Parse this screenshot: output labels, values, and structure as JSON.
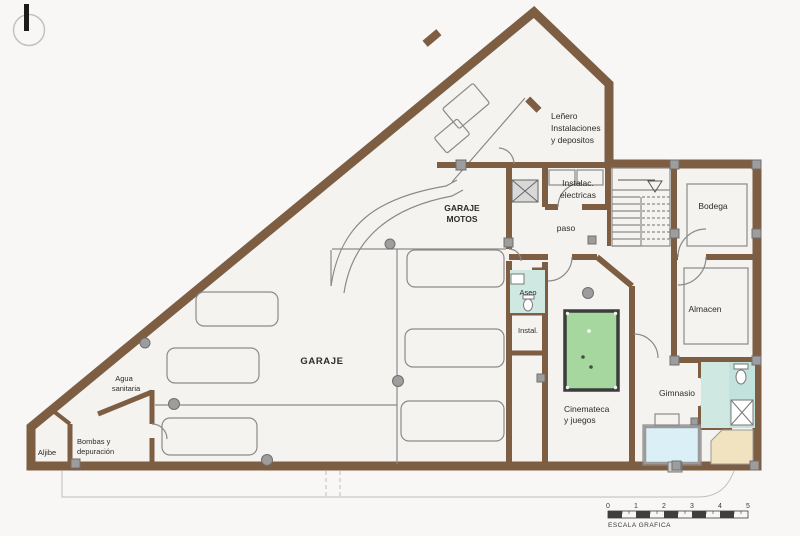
{
  "drawing": {
    "type": "architectural-floor-plan",
    "level": "basement-garage-level"
  },
  "colors": {
    "wall": "#7d5e43",
    "floor": "#f5f3ef",
    "background": "#f8f7f5",
    "column": "#9d9d9d",
    "thin_line": "#8a8a8a",
    "pool_table": "#a5d79f",
    "pool_border": "#3c3c3c",
    "bath_floor": "#cfe8e2",
    "bath_floor_dark": "#c2e2de",
    "sauna": "#f2e3c0",
    "equipment": "#dbf0f6",
    "ink": "#2e2c28"
  },
  "rooms": {
    "lenero": {
      "lines": [
        "Leñero",
        "Instalaciones",
        "y depositos"
      ]
    },
    "garaje_motos": {
      "lines": [
        "GARAJE",
        "MOTOS"
      ]
    },
    "instalac_electricas": {
      "lines": [
        "Instalac.",
        "electricas"
      ]
    },
    "paso": {
      "label": "paso"
    },
    "bodega": {
      "label": "Bodega"
    },
    "aseo": {
      "label": "Aseo"
    },
    "instal": {
      "label": "Instal."
    },
    "almacen": {
      "label": "Almacen"
    },
    "garaje": {
      "label": "GARAJE"
    },
    "cinemateca": {
      "lines": [
        "Cinemateca",
        "y juegos"
      ]
    },
    "gimnasio": {
      "label": "Gimnasio"
    },
    "agua_sanitaria": {
      "lines": [
        "Agua",
        "sanitaria"
      ]
    },
    "aljibe": {
      "label": "Aljibe"
    },
    "bombas": {
      "lines": [
        "Bombas y",
        "depuración"
      ]
    }
  },
  "scale_bar": {
    "ticks": [
      "0",
      "1",
      "2",
      "3",
      "4",
      "5"
    ],
    "caption": "ESCALA GRAFICA"
  }
}
